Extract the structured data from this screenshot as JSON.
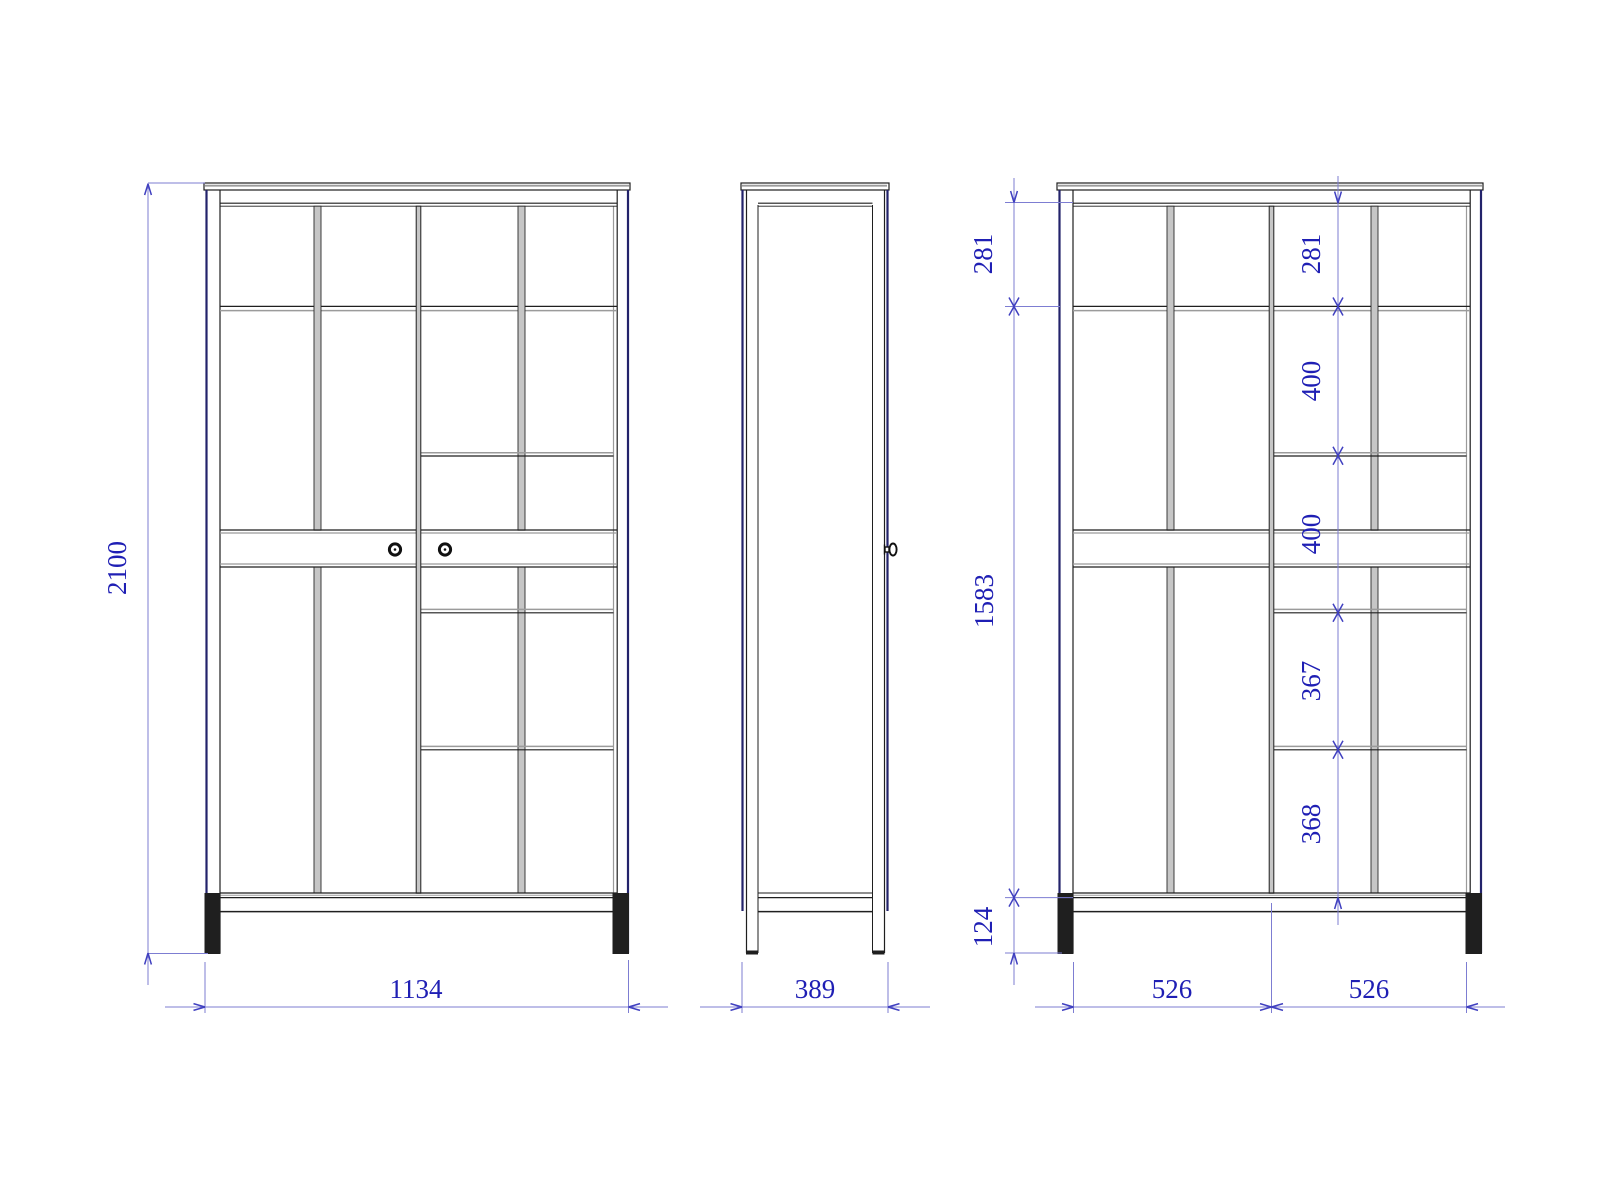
{
  "drawing": {
    "type": "furniture orthographic drawing",
    "subject": "two-door wardrobe with internal shelves",
    "views": {
      "front": {
        "label": "front view"
      },
      "side": {
        "label": "side view"
      },
      "internal": {
        "label": "internal dimension view"
      }
    }
  },
  "dims": {
    "overall_height": "2100",
    "overall_width": "1134",
    "depth": "389",
    "left_top": "281",
    "left_span": "1583",
    "leg": "124",
    "right_top": "281",
    "gap1": "400",
    "gap2": "400",
    "gap3": "367",
    "gap4": "368",
    "bay_left": "526",
    "bay_right": "526"
  },
  "colors": {
    "line": "#1f1f1f",
    "gray": "#9b9b9b",
    "navy": "#23236b",
    "dimline": "#7d7dd2",
    "term": "#4040c0",
    "dimtext": "#1f1fb4",
    "fillgray": "#c6c6c6",
    "bg": "#ffffff"
  }
}
